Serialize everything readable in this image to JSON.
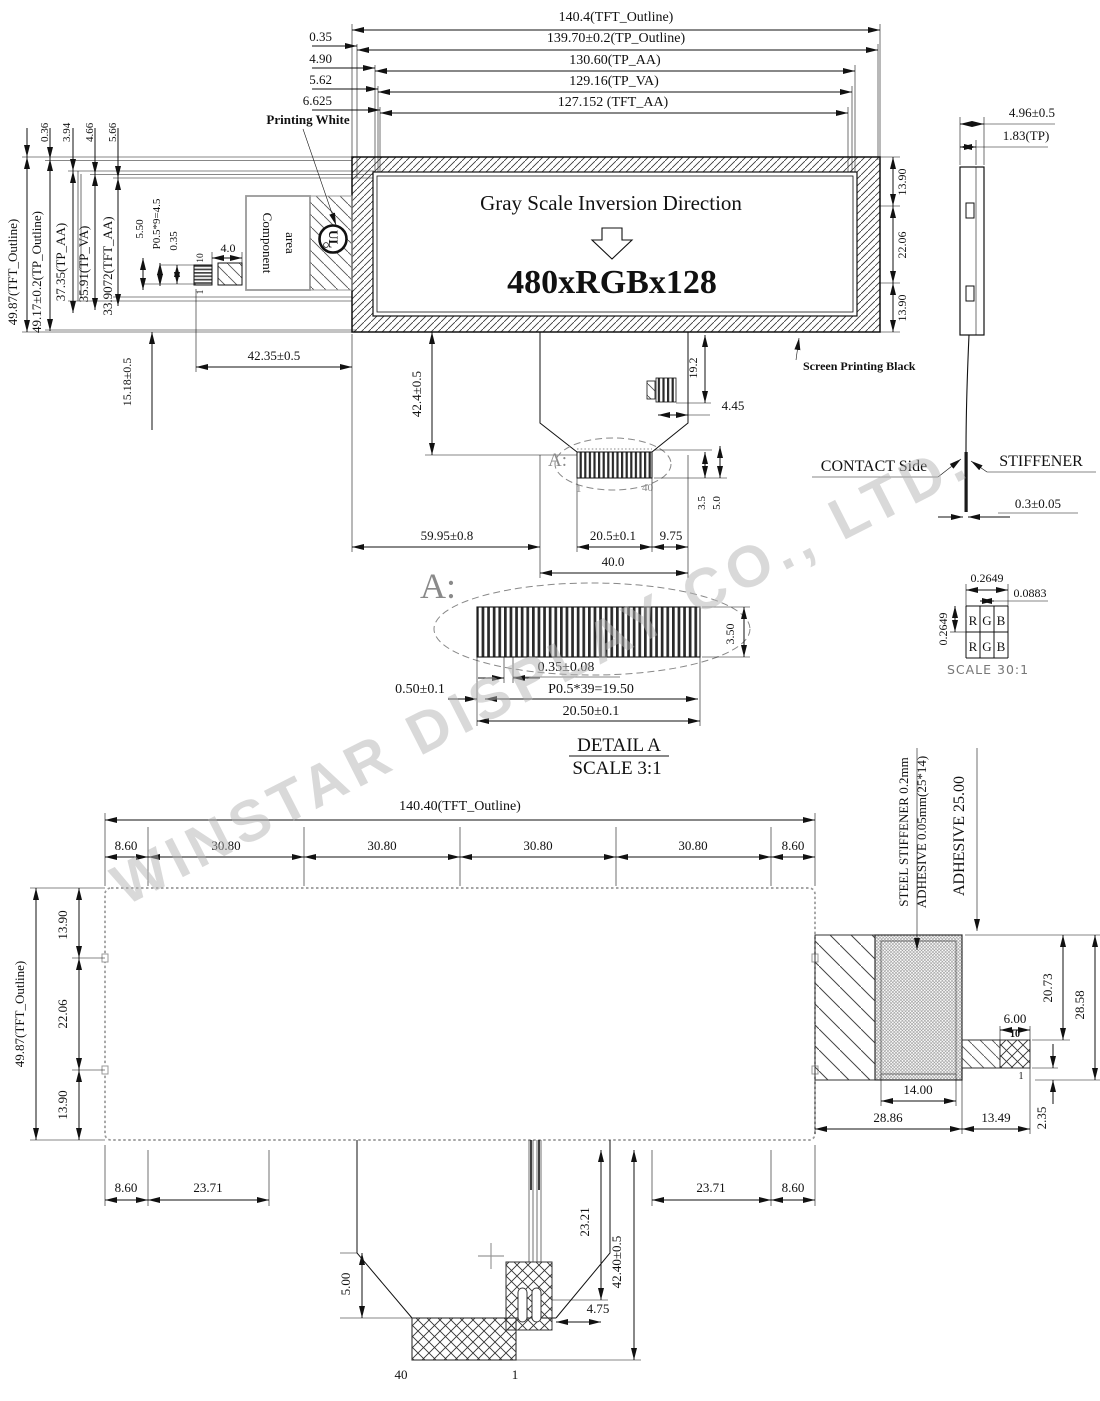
{
  "watermark": "WINSTAR DISPLAY CO., LTD.",
  "top_view": {
    "h_dims": [
      "140.4(TFT_Outline)",
      "139.70±0.2(TP_Outline)",
      "130.60(TP_AA)",
      "129.16(TP_VA)",
      "127.152 (TFT_AA)"
    ],
    "h_offsets": [
      "0.35",
      "4.90",
      "5.62",
      "6.625"
    ],
    "v_dims": [
      "49.87(TFT_Outline)",
      "49.17±0.2(TP_Outline)",
      "37.35(TP_AA)",
      "35.91(TP_VA)",
      "33.9072(TFT_AA)"
    ],
    "v_offsets": [
      "0.36",
      "3.94",
      "4.66",
      "5.66"
    ],
    "display": {
      "line1": "Gray Scale Inversion Direction",
      "resolution": "480xRGBx128"
    },
    "right_dims": [
      "13.90",
      "22.06",
      "13.90"
    ],
    "labels": {
      "printing_white": "Printing White",
      "component_line1": "Component",
      "component_line2": "area",
      "ul": "UL",
      "screen_printing_black": "Screen Printing Black"
    },
    "connector": {
      "pin_top": "10",
      "pin_bottom": "1",
      "width": "4.0",
      "pitch": "P0.5*9=4.5",
      "pin_w": "0.35",
      "offset": "5.50"
    },
    "dims": {
      "fpc_drop": "15.18±0.5",
      "fpc_len": "42.35±0.5"
    }
  },
  "tail_view": {
    "a_label": "A:",
    "pin_first": "1",
    "pin_last": "40",
    "dims": {
      "drop": "42.4±0.5",
      "comp_h": "19.2",
      "comp_w": "4.45",
      "left": "59.95±0.8",
      "contact": "20.5±0.1",
      "side": "9.75",
      "w": "40.0",
      "h1": "3.5",
      "h2": "5.0"
    }
  },
  "side_view": {
    "dims": {
      "total": "4.96±0.5",
      "tp": "1.83(TP)",
      "stiffener_t": "0.3±0.05"
    },
    "labels": {
      "contact": "CONTACT Side",
      "stiffener": "STIFFENER"
    }
  },
  "detail_a": {
    "a_label": "A:",
    "title": "DETAIL A",
    "scale": "SCALE 3:1",
    "dims": {
      "pin": "0.35±0.08",
      "pitch": "P0.5*39=19.50",
      "margin": "0.50±0.1",
      "total": "20.50±0.1",
      "height": "3.50"
    }
  },
  "rgb_detail": {
    "dims": {
      "pitch_h": "0.2649",
      "sub": "0.0883",
      "pitch_v": "0.2649"
    },
    "r": "R",
    "g": "G",
    "b": "B",
    "scale": "SCALE 30:1"
  },
  "bottom_view": {
    "width_dim": "140.40(TFT_Outline)",
    "segments": [
      "8.60",
      "30.80",
      "30.80",
      "30.80",
      "30.80",
      "8.60"
    ],
    "height_dim": "49.87(TFT_Outline)",
    "v_dims": [
      "13.90",
      "22.06",
      "13.90"
    ],
    "labels": {
      "steel": "STEEL STIFFENER  0.2mm",
      "adhesive_thin": "ADHESIVE 0.05mm(25*14)",
      "adhesive": "ADHESIVE 25.00"
    },
    "stiffener_dims": {
      "tab_w": "6.00",
      "pin_top": "10",
      "pin_bottom": "1",
      "h1": "20.73",
      "h2": "28.58",
      "w": "14.00",
      "total_w": "28.86",
      "tab_total": "13.49",
      "step": "2.35"
    },
    "bottom_dims": {
      "l1": "8.60",
      "l2": "23.71",
      "r2": "23.71",
      "r1": "8.60",
      "wire": "23.21",
      "drop": "42.40±0.5",
      "tail": "5.00",
      "offset": "4.75",
      "pin_last": "40",
      "pin_first": "1"
    }
  }
}
